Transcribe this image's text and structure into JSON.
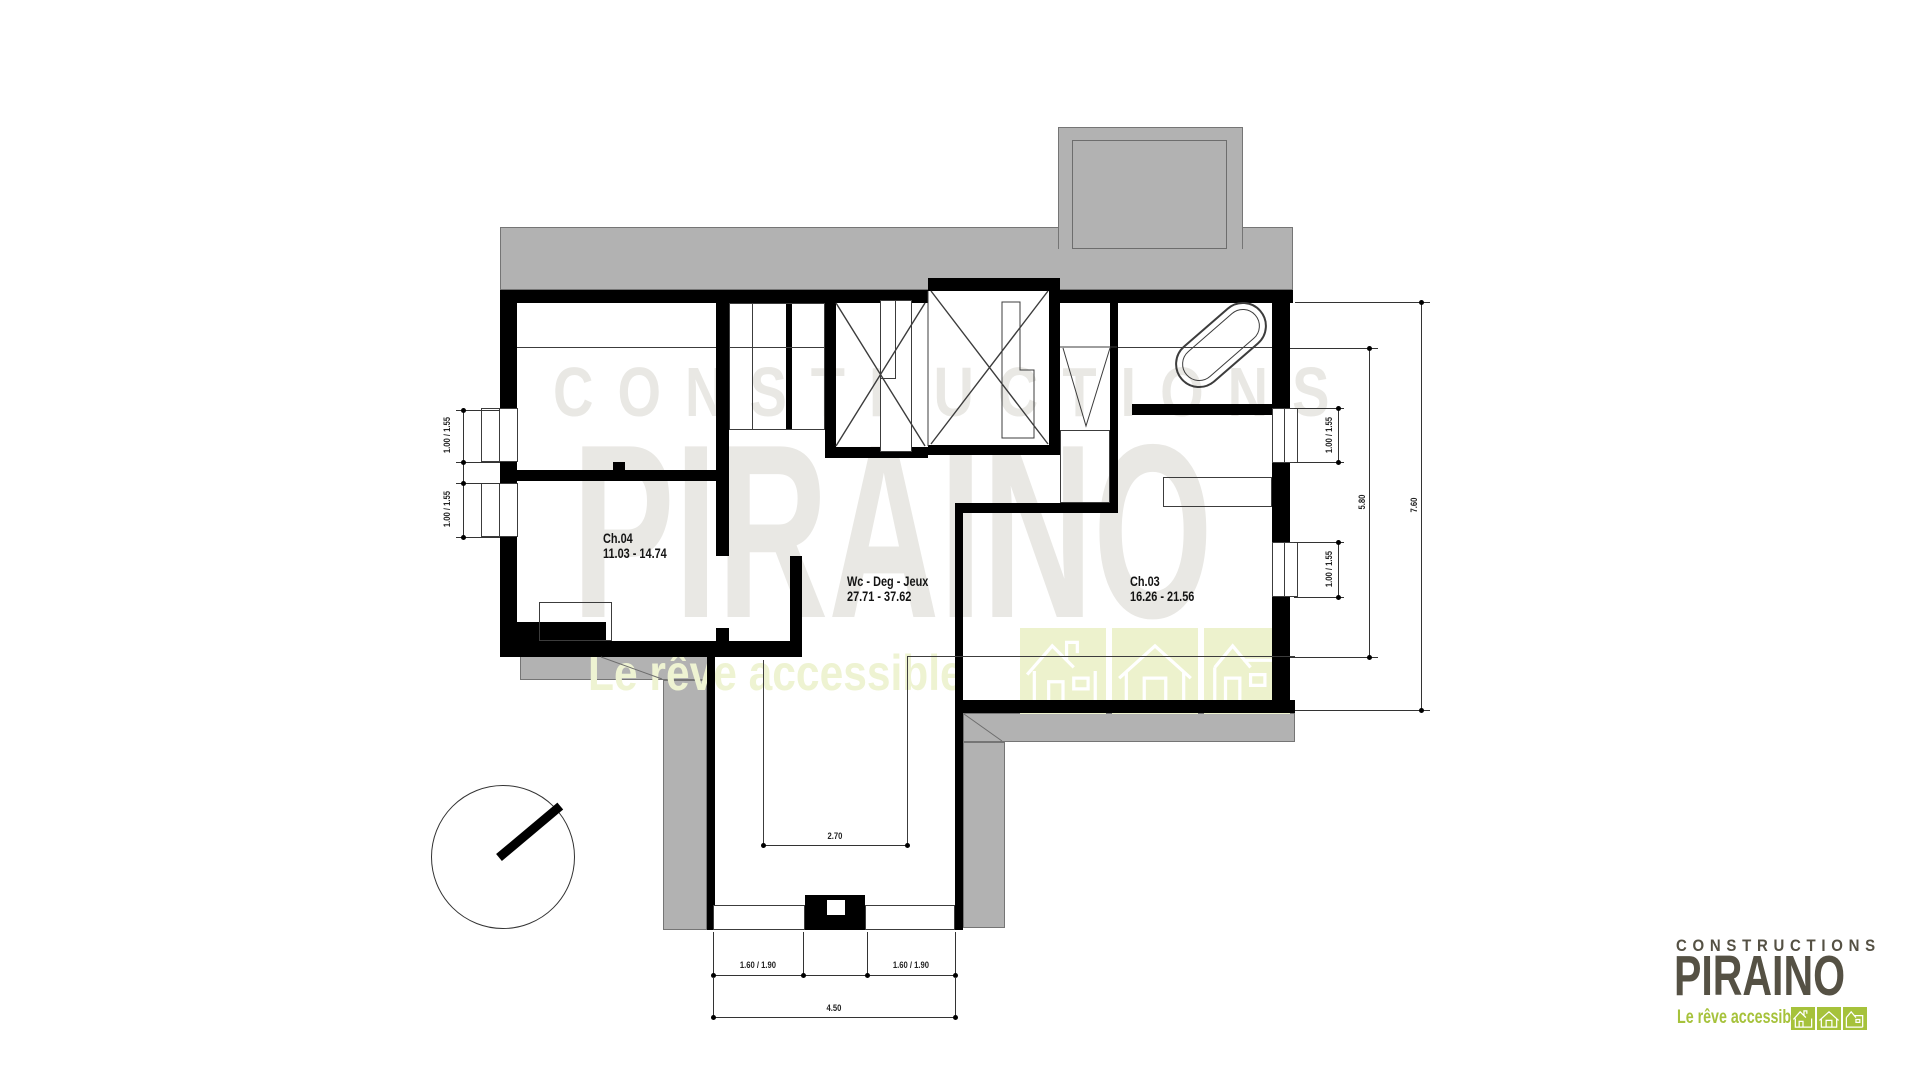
{
  "colors": {
    "wall_black": "#000000",
    "roof_gray": "#b2b2b2",
    "brand_green": "#a6c23b",
    "watermark_gray": "#e9e8e4",
    "watermark_green": "#edf2cd",
    "logo_text": "#555144"
  },
  "watermark": {
    "line1": "CONSTRUCTIONS",
    "line2": "PIRAINO",
    "tagline": "Le rêve accessible"
  },
  "logo": {
    "line1": "CONSTRUCTIONS",
    "line2": "PIRAINO",
    "tagline": "Le rêve accessible"
  },
  "rooms": [
    {
      "name": "Ch.04",
      "area": "11.03 - 14.74"
    },
    {
      "name": "Wc - Deg - Jeux",
      "area": "27.71 - 37.62"
    },
    {
      "name": "Ch.03",
      "area": "16.26 - 21.56"
    }
  ],
  "dimensions": {
    "left_window_top": "1.00 / 1.55",
    "left_window_bottom": "1.00 / 1.55",
    "right_window_top": "1.00 / 1.55",
    "right_window_bottom": "1.00 / 1.55",
    "right_inner": "5.80",
    "right_overall": "7.60",
    "opening": "2.70",
    "bottom_window_left": "1.60 / 1.90",
    "bottom_window_right": "1.60 / 1.90",
    "bottom_overall": "4.50"
  }
}
